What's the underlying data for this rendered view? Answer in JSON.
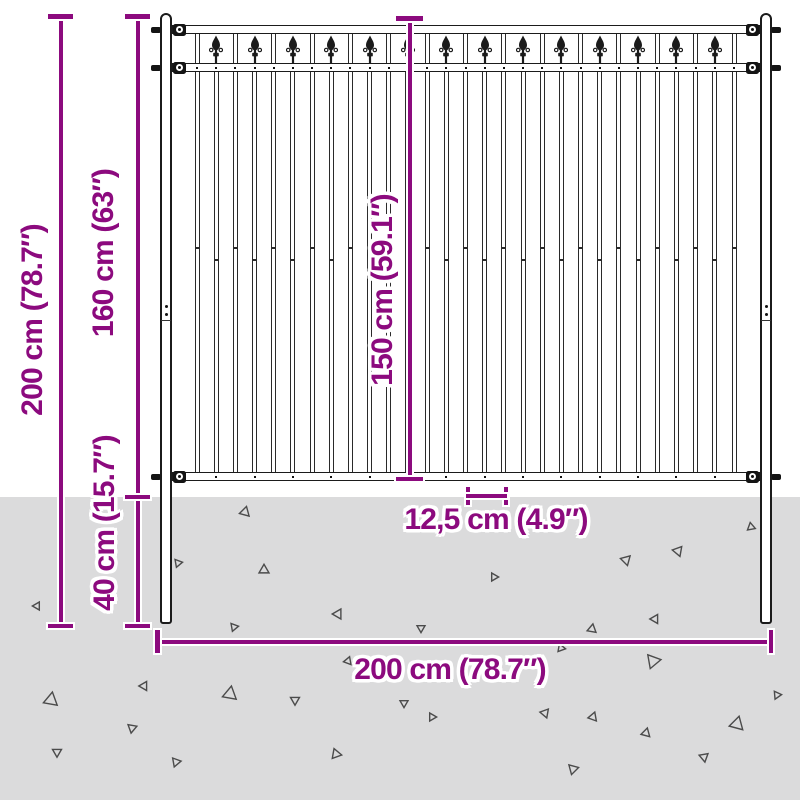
{
  "image_kind": "fence-panel-dimension-diagram",
  "labels": {
    "total_height": "200 cm (78.7″)",
    "above_ground": "160 cm (63″)",
    "below_ground": "40 cm (15.7″)",
    "panel_height": "150 cm (59.1″)",
    "picket_spacing": "12,5 cm (4.9″)",
    "total_width": "200 cm (78.7″)"
  },
  "colors": {
    "dimension": "#8c0a7e",
    "ground": "#dbdbdc",
    "metal": "#1b1b1b",
    "triangle_outline": "#4b4b4b",
    "background": "#ffffff"
  },
  "fence": {
    "post_count": 2,
    "rail_count": 3,
    "picket_count": 29,
    "main_picket_count": 15,
    "spear_finial_count": 14,
    "bracket_count": 6
  },
  "triangles": [
    {
      "x": 245,
      "y": 512,
      "s": 10,
      "r": 15
    },
    {
      "x": 178,
      "y": 563,
      "s": 8,
      "r": 200
    },
    {
      "x": 264,
      "y": 570,
      "s": 10,
      "r": 120
    },
    {
      "x": 37,
      "y": 606,
      "s": 8,
      "r": 270
    },
    {
      "x": 338,
      "y": 614,
      "s": 10,
      "r": 30
    },
    {
      "x": 144,
      "y": 686,
      "s": 9,
      "r": 150
    },
    {
      "x": 51,
      "y": 700,
      "s": 14,
      "r": 10
    },
    {
      "x": 230,
      "y": 694,
      "s": 14,
      "r": 250
    },
    {
      "x": 295,
      "y": 700,
      "s": 9,
      "r": 60
    },
    {
      "x": 132,
      "y": 728,
      "s": 9,
      "r": 190
    },
    {
      "x": 57,
      "y": 752,
      "s": 9,
      "r": 300
    },
    {
      "x": 336,
      "y": 754,
      "s": 10,
      "r": 220
    },
    {
      "x": 176,
      "y": 762,
      "s": 9,
      "r": 80
    },
    {
      "x": 348,
      "y": 661,
      "s": 8,
      "r": 140
    },
    {
      "x": 234,
      "y": 627,
      "s": 8,
      "r": 200
    },
    {
      "x": 421,
      "y": 628,
      "s": 8,
      "r": 180
    },
    {
      "x": 494,
      "y": 577,
      "s": 8,
      "r": 330
    },
    {
      "x": 626,
      "y": 560,
      "s": 10,
      "r": 45
    },
    {
      "x": 678,
      "y": 551,
      "s": 10,
      "r": 160
    },
    {
      "x": 751,
      "y": 527,
      "s": 8,
      "r": 230
    },
    {
      "x": 592,
      "y": 629,
      "s": 9,
      "r": 10
    },
    {
      "x": 655,
      "y": 619,
      "s": 9,
      "r": 270
    },
    {
      "x": 561,
      "y": 648,
      "s": 8,
      "r": 100
    },
    {
      "x": 653,
      "y": 661,
      "s": 14,
      "r": 320
    },
    {
      "x": 545,
      "y": 713,
      "s": 9,
      "r": 40
    },
    {
      "x": 404,
      "y": 703,
      "s": 8,
      "r": 180
    },
    {
      "x": 432,
      "y": 717,
      "s": 8,
      "r": 90
    },
    {
      "x": 593,
      "y": 717,
      "s": 9,
      "r": 260
    },
    {
      "x": 646,
      "y": 733,
      "s": 9,
      "r": 135
    },
    {
      "x": 737,
      "y": 724,
      "s": 14,
      "r": 15
    },
    {
      "x": 777,
      "y": 695,
      "s": 8,
      "r": 205
    },
    {
      "x": 573,
      "y": 769,
      "s": 10,
      "r": 75
    },
    {
      "x": 704,
      "y": 757,
      "s": 9,
      "r": 290
    }
  ]
}
